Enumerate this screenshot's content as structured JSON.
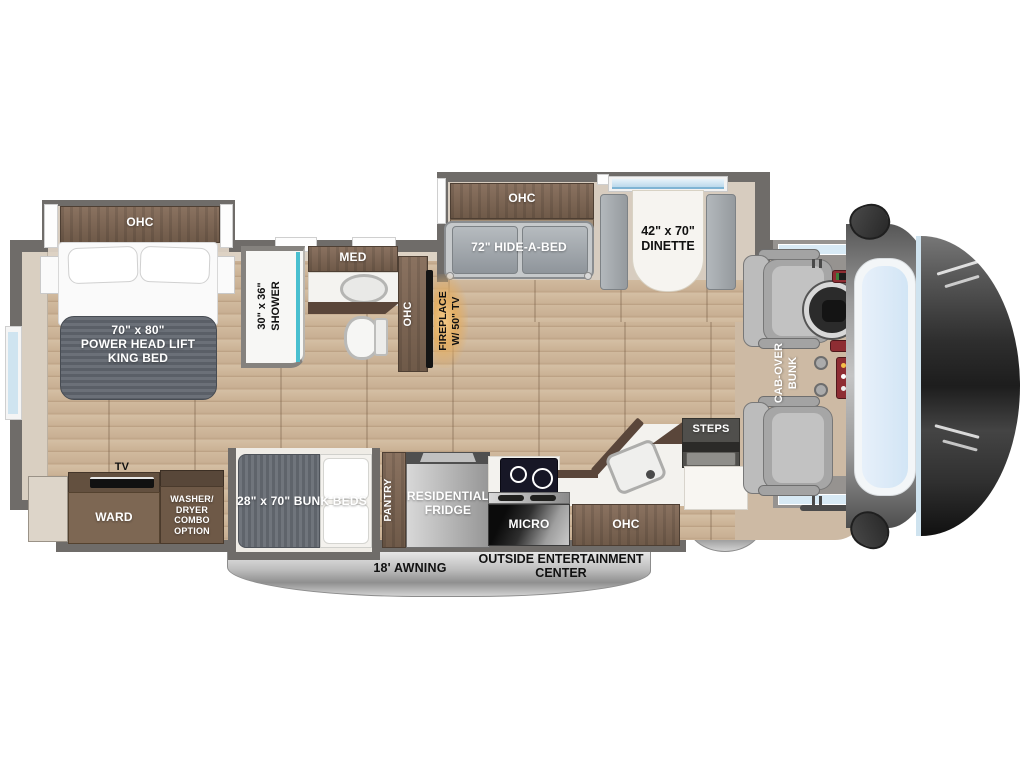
{
  "title_hint": "RV motorhome floor plan diagram",
  "colors": {
    "floor_wood": "#c9b299",
    "wall_gray": "#6f6c69",
    "cabinet_brown": "#7b6351",
    "slide_interior_beige": "#d7ccbf",
    "mattress_gray": "#61666e",
    "sofa_gray": "#9aa0a6",
    "awning_silver": "#c0c0c0",
    "windshield_blue": "#cfe4f2",
    "front_cap_dark": "#1e1e1e",
    "shower_accent_teal": "#49bfcf",
    "fireplace_glow_amber": "#e2ae66"
  },
  "labels": {
    "bedroom_ohc": "OHC",
    "king_bed_l1": "70\" x 80\"",
    "king_bed_l2": "POWER  HEAD LIFT",
    "king_bed_l3": "KING BED",
    "shower_l1": "30\" x 36\"",
    "shower_l2": "SHOWER",
    "med": "MED",
    "bath_ohc": "OHC",
    "fireplace_l1": "FIREPLACE",
    "fireplace_l2": "W/ 50\" TV",
    "living_ohc": "OHC",
    "hide_a_bed": "72\" HIDE-A-BED",
    "dinette_l1": "42\" x 70\"",
    "dinette_l2": "DINETTE",
    "cab_over_l1": "CAB-OVER",
    "cab_over_l2": "BUNK",
    "steps": "STEPS",
    "tv": "TV",
    "ward": "WARD",
    "washer_l1": "WASHER/",
    "washer_l2": "DRYER",
    "washer_l3": "COMBO",
    "washer_l4": "OPTION",
    "bunk_beds": "28\" x 70\" BUNK BEDS",
    "pantry": "PANTRY",
    "fridge_l1": "RESIDENTIAL",
    "fridge_l2": "FRIDGE",
    "micro": "MICRO",
    "kitchen_ohc": "OHC",
    "door_awning_l1": "DOOR",
    "door_awning_l2": "AWNING",
    "awning": "18' AWNING",
    "entertainment_l1": "OUTSIDE ENTERTAINMENT",
    "entertainment_l2": "CENTER"
  }
}
